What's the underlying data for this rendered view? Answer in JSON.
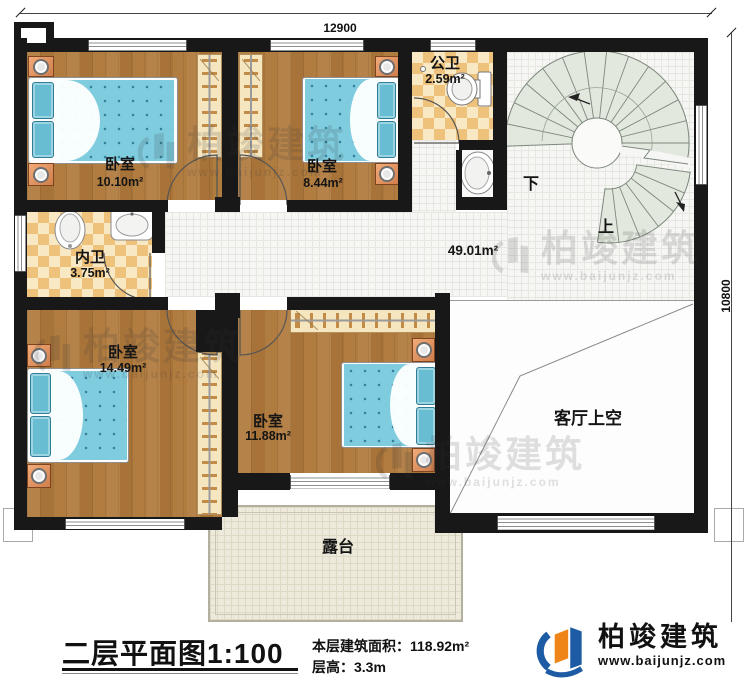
{
  "plan": {
    "dimensions": {
      "width_mm": "12900",
      "height_mm": "10800"
    },
    "rooms": {
      "bedroom_top_left": {
        "name": "卧室",
        "area": "10.10m²"
      },
      "bedroom_top_mid": {
        "name": "卧室",
        "area": "8.44m²"
      },
      "public_bath": {
        "name": "公卫",
        "area": "2.59m²"
      },
      "ensuite_bath": {
        "name": "内卫",
        "area": "3.75m²"
      },
      "hall": {
        "area": "49.01m²"
      },
      "bedroom_bottom_left": {
        "name": "卧室",
        "area": "14.49m²"
      },
      "bedroom_bottom_mid": {
        "name": "卧室",
        "area": "11.88m²"
      },
      "living_room_void": {
        "name": "客厅上空"
      },
      "terrace": {
        "name": "露台"
      }
    },
    "stairs": {
      "down_label": "下",
      "up_label": "上"
    }
  },
  "caption": {
    "title": "二层平面图",
    "scale": "1:100",
    "floor_area_label": "本层建筑面积：",
    "floor_area_value": "118.92m²",
    "floor_height_label": "层高：",
    "floor_height_value": "3.3m"
  },
  "brand": {
    "name": "柏竣建筑",
    "website": "www.baijunjz.com"
  },
  "watermark": {
    "name": "柏竣建筑",
    "website": "www.baijunjz.com"
  },
  "colors": {
    "wall": "#181818",
    "wood": "#b0803f",
    "checker_tile": "#efc27b",
    "mattress_blue": "#7fccdf",
    "stair_tread": "#e2e8de",
    "terrace": "#edeadb",
    "brand_blue": "#1d5ca5",
    "brand_orange": "#ef8418"
  }
}
